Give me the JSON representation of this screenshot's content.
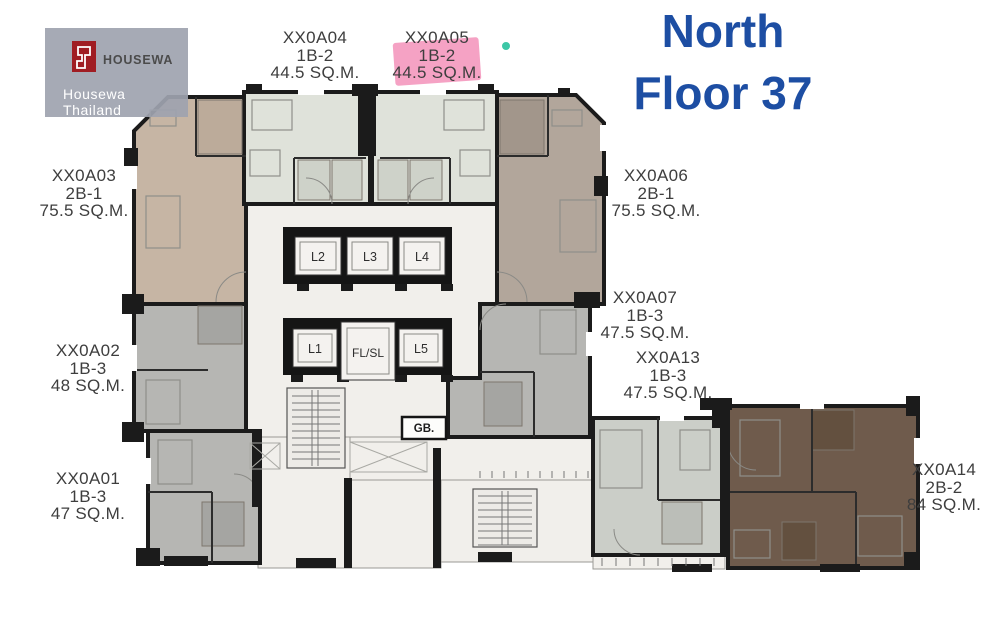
{
  "page": {
    "background": "#ffffff"
  },
  "branding": {
    "logo_text": "HOUSEWA",
    "watermark": "Housewa Thailand",
    "logo_red": "#a01d23",
    "box_bg": "#9ea3af"
  },
  "title": {
    "line1": "North",
    "line2": "Floor 37",
    "color": "#1d4ea3"
  },
  "highlight": {
    "unit": "XX0A05",
    "color": "#f392ba",
    "marker_dot_color": "#3cc7a6"
  },
  "units": [
    {
      "id": "XX0A01",
      "type": "1B-3",
      "area": "47 SQ.M.",
      "fill": "#b6b6b3",
      "highlighted": false
    },
    {
      "id": "XX0A02",
      "type": "1B-3",
      "area": "48 SQ.M.",
      "fill": "#b6b6b3",
      "highlighted": false
    },
    {
      "id": "XX0A03",
      "type": "2B-1",
      "area": "75.5 SQ.M.",
      "fill": "#c6b5a4",
      "highlighted": false
    },
    {
      "id": "XX0A04",
      "type": "1B-2",
      "area": "44.5 SQ.M.",
      "fill": "#dfe2da",
      "highlighted": false
    },
    {
      "id": "XX0A05",
      "type": "1B-2",
      "area": "44.5 SQ.M.",
      "fill": "#dfe2da",
      "highlighted": true
    },
    {
      "id": "XX0A06",
      "type": "2B-1",
      "area": "75.5 SQ.M.",
      "fill": "#b2a69b",
      "highlighted": false
    },
    {
      "id": "XX0A07",
      "type": "1B-3",
      "area": "47.5 SQ.M.",
      "fill": "#b6b6b3",
      "highlighted": false
    },
    {
      "id": "XX0A13",
      "type": "1B-3",
      "area": "47.5 SQ.M.",
      "fill": "#cbcec8",
      "highlighted": false
    },
    {
      "id": "XX0A14",
      "type": "2B-2",
      "area": "84 SQ.M.",
      "fill": "#6f5b4c",
      "highlighted": false
    }
  ],
  "core": {
    "lifts_top": [
      "L2",
      "L3",
      "L4"
    ],
    "lifts_bottom": [
      "L1",
      "FL/SL",
      "L5"
    ],
    "garbage_label": "GB."
  },
  "walls": {
    "color": "#1b1b1b",
    "core_fill": "#f1efeb"
  }
}
